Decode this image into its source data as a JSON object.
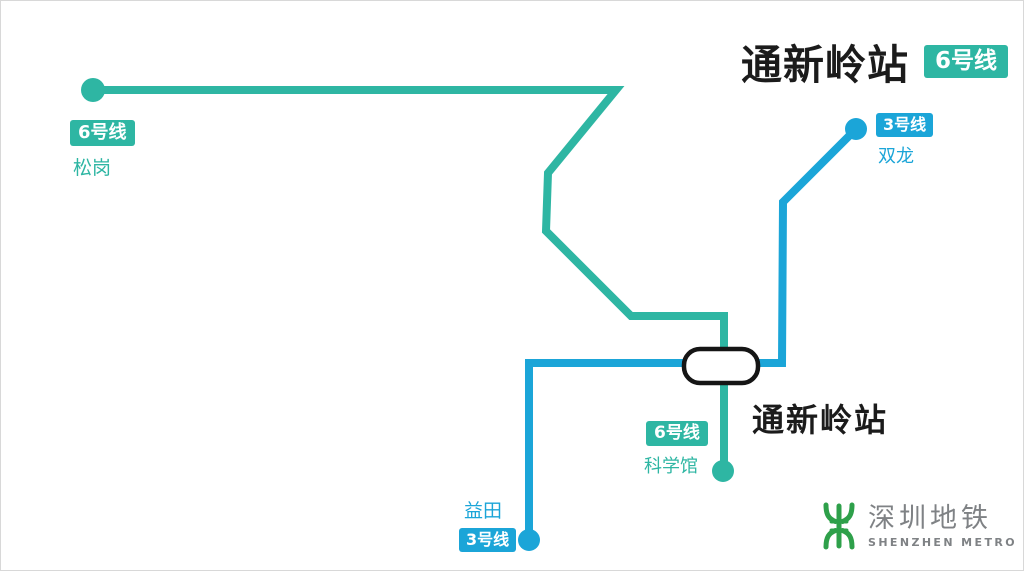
{
  "header": {
    "station_name": "通新岭站",
    "line_badge": "6号线"
  },
  "map": {
    "station": {
      "label": "通新岭站"
    },
    "terminals": [
      {
        "id": "songgang",
        "line_badge": "6号线",
        "name": "松岗"
      },
      {
        "id": "shuanglong",
        "line_badge": "3号线",
        "name": "双龙"
      },
      {
        "id": "kexueguan",
        "line_badge": "6号线",
        "name": "科学馆"
      },
      {
        "id": "yitian",
        "line_badge": "3号线",
        "name": "益田"
      }
    ]
  },
  "logo": {
    "name_cn": "深圳地铁",
    "name_en": "SHENZHEN METRO"
  },
  "colors": {
    "line6_teal": "#2EB6A3",
    "line3_blue": "#1BA5D8",
    "logo_green": "#2EA04A",
    "logo_gray": "#7F8285",
    "ink": "#1B1B1B"
  }
}
